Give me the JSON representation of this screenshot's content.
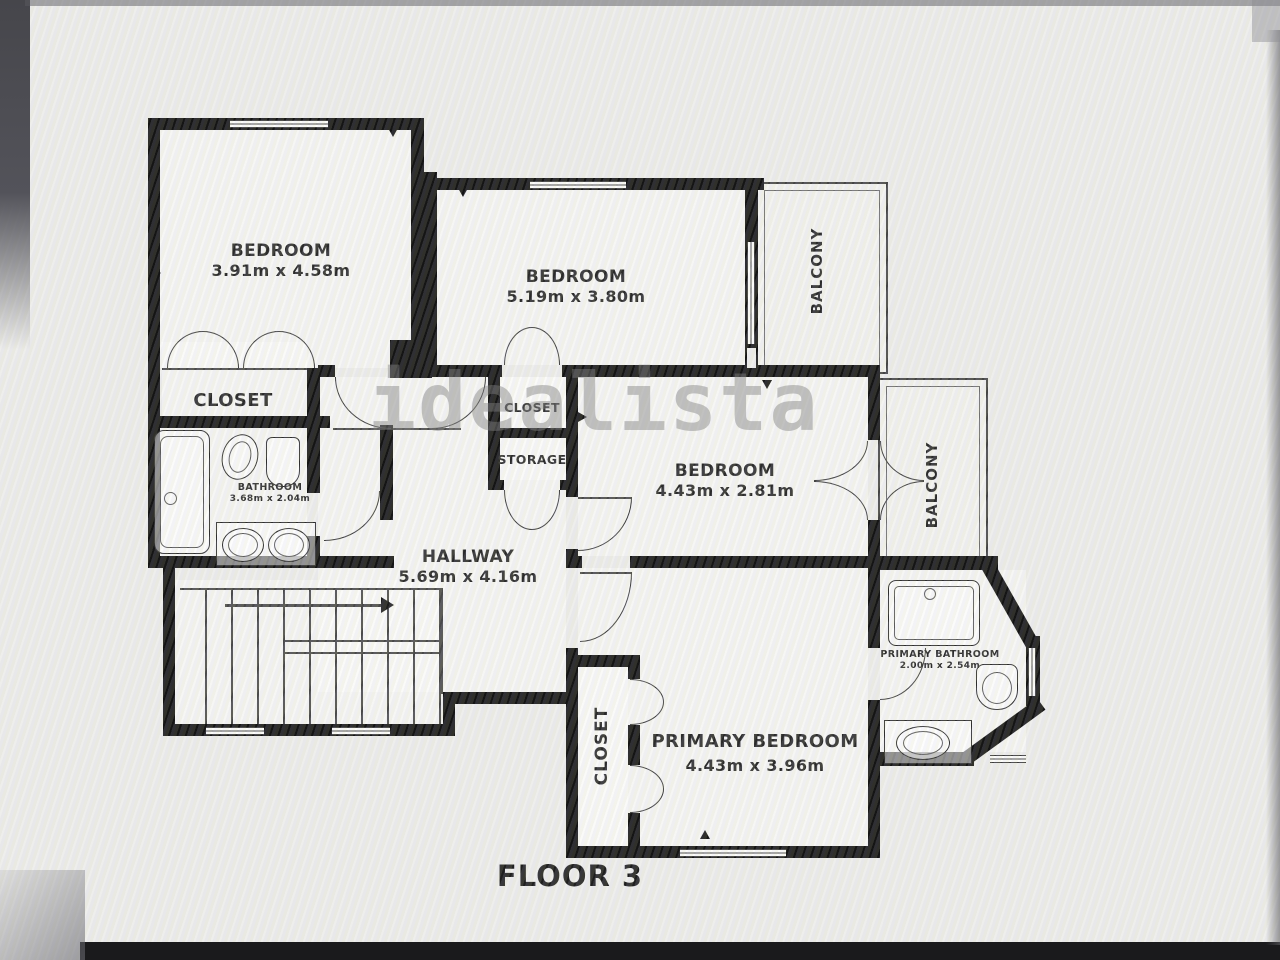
{
  "floor_title": "FLOOR 3",
  "watermark": "idealista",
  "rooms": {
    "bedroom1": {
      "name": "BEDROOM",
      "dims": "3.91m x 4.58m"
    },
    "bedroom2": {
      "name": "BEDROOM",
      "dims": "5.19m x 3.80m"
    },
    "bedroom3": {
      "name": "BEDROOM",
      "dims": "4.43m x 2.81m"
    },
    "primary_bedroom": {
      "name": "PRIMARY BEDROOM",
      "dims": "4.43m x 3.96m"
    },
    "hallway": {
      "name": "HALLWAY",
      "dims": "5.69m x 4.16m"
    },
    "bathroom": {
      "name": "BATHROOM",
      "dims": "3.68m x 2.04m"
    },
    "primary_bathroom": {
      "name": "PRIMARY BATHROOM",
      "dims": "2.00m x 2.54m"
    },
    "closet_main": {
      "name": "CLOSET"
    },
    "closet_hall": {
      "name": "CLOSET"
    },
    "storage": {
      "name": "STORAGE"
    },
    "closet_primary": {
      "name": "CLOSET"
    },
    "balcony_top": {
      "name": "BALCONY"
    },
    "balcony_side": {
      "name": "BALCONY"
    }
  },
  "colors": {
    "wall": "#151515",
    "line": "#4a4a4a",
    "label": "#2b2b2b",
    "watermark": "#8a8a8a"
  }
}
